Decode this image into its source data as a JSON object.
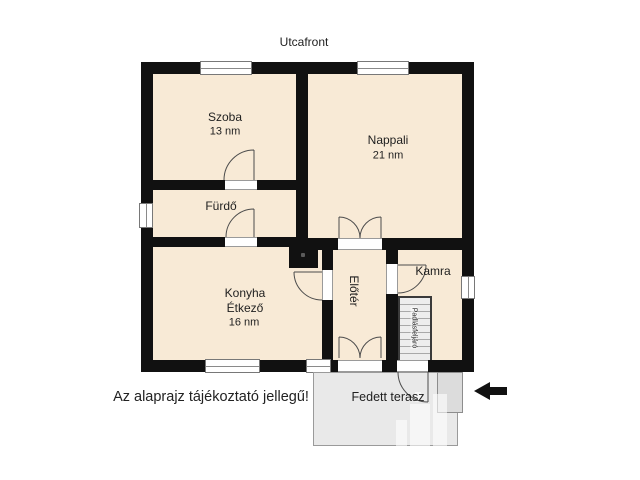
{
  "meta": {
    "street_label": "Utcafront",
    "disclaimer": "Az alaprajz tájékoztató jellegű!"
  },
  "rooms": {
    "szoba": {
      "name": "Szoba",
      "area": "13 nm"
    },
    "nappali": {
      "name": "Nappali",
      "area": "21 nm"
    },
    "furdo": {
      "name": "Fürdő"
    },
    "konyha": {
      "name": "Konyha",
      "name2": "Étkező",
      "area": "16 nm"
    },
    "kamra": {
      "name": "Kamra"
    },
    "eloter": {
      "name": "Előtér"
    },
    "stairs": {
      "name": "Padlásfeljáró"
    },
    "terasz": {
      "name": "Fedett terasz"
    }
  },
  "icons": {
    "entrance_arrow": "left-arrow-icon",
    "watermark": "buildings-logo-watermark"
  },
  "colors": {
    "wall": "#111111",
    "room_fill": "#f8ead6",
    "terrace_fill": "#e9e9e9",
    "text": "#1f1f1f"
  }
}
